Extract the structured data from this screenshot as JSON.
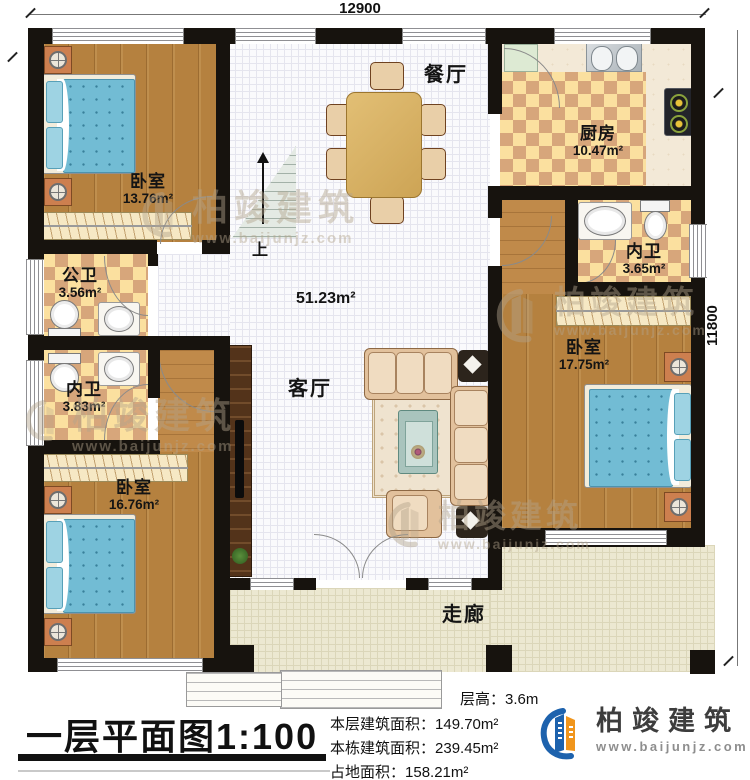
{
  "plan": {
    "dim_width": "12900",
    "dim_height": "11800",
    "rooms": {
      "bedroom_top_left": {
        "label": "卧室",
        "area": "13.76m²"
      },
      "dining": {
        "label": "餐厅"
      },
      "kitchen": {
        "label": "厨房",
        "area": "10.47m²"
      },
      "bath_top_right": {
        "label": "内卫",
        "area": "3.65m²"
      },
      "bedroom_right": {
        "label": "卧室",
        "area": "17.75m²"
      },
      "bath_public": {
        "label": "公卫",
        "area": "3.56m²"
      },
      "bath_left": {
        "label": "内卫",
        "area": "3.83m²"
      },
      "bedroom_bottom_left": {
        "label": "卧室",
        "area": "16.76m²"
      },
      "living": {
        "label": "客厅",
        "area": "51.23m²"
      },
      "corridor": {
        "label": "走廊"
      },
      "stairs_up": "上"
    }
  },
  "footer": {
    "title": "一层平面图",
    "scale": "1:100",
    "stats": [
      {
        "label": "层高：",
        "value": "3.6m"
      },
      {
        "label": "本层建筑面积：",
        "value": "149.70m²"
      },
      {
        "label": "本栋建筑面积：",
        "value": "239.45m²"
      },
      {
        "label": "占地面积：",
        "value": "158.21m²"
      }
    ],
    "logo_name": "柏竣建筑",
    "logo_website": "www.baijunjz.com"
  },
  "watermark": {
    "name": "柏竣建筑",
    "website": "www.baijunjz.com"
  }
}
